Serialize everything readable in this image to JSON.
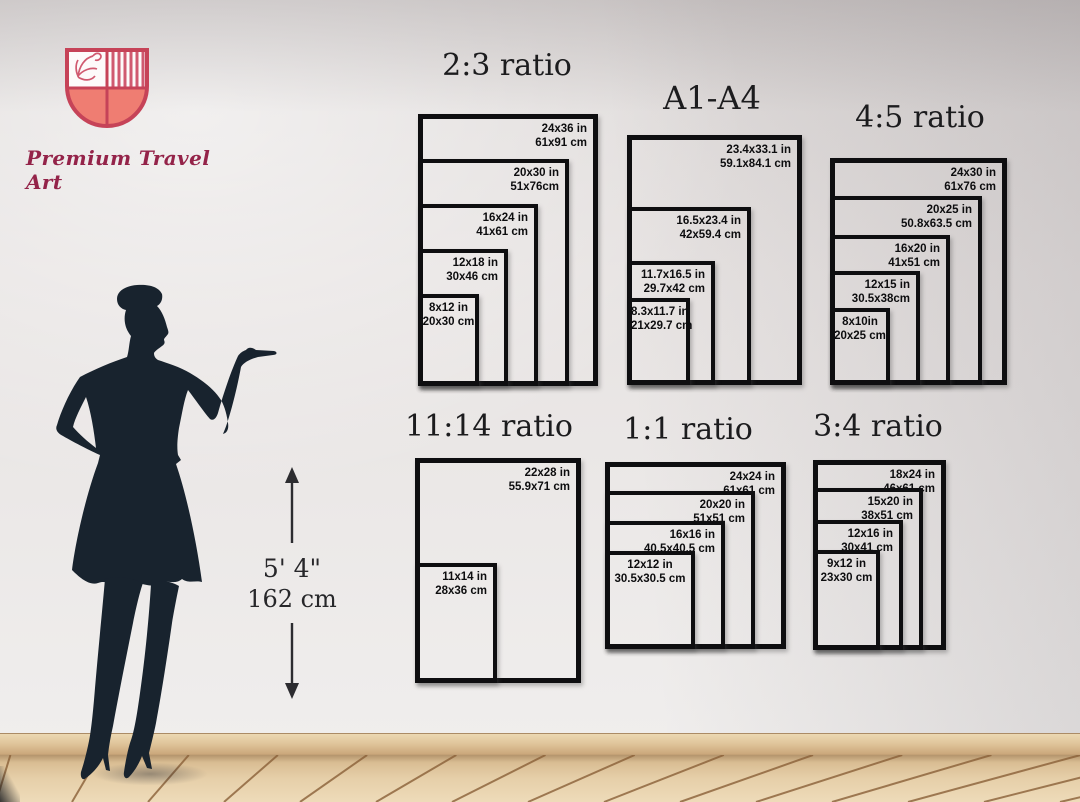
{
  "brand": {
    "name": "Premium Travel Art"
  },
  "height_indicator": {
    "feet": "5' 4\"",
    "cm": "162 cm"
  },
  "groups": [
    {
      "title": "2:3 ratio",
      "sizes": [
        {
          "inches": "24x36 in",
          "cm": "61x91 cm"
        },
        {
          "inches": "20x30 in",
          "cm": "51x76cm"
        },
        {
          "inches": "16x24 in",
          "cm": "41x61 cm"
        },
        {
          "inches": "12x18 in",
          "cm": "30x46 cm"
        },
        {
          "inches": "8x12 in",
          "cm": "20x30 cm"
        }
      ]
    },
    {
      "title": "A1-A4",
      "sizes": [
        {
          "inches": "23.4x33.1 in",
          "cm": "59.1x84.1 cm"
        },
        {
          "inches": "16.5x23.4 in",
          "cm": "42x59.4 cm"
        },
        {
          "inches": "11.7x16.5 in",
          "cm": "29.7x42 cm"
        },
        {
          "inches": "8.3x11.7 in",
          "cm": "21x29.7 cm"
        }
      ]
    },
    {
      "title": "4:5 ratio",
      "sizes": [
        {
          "inches": "24x30 in",
          "cm": "61x76 cm"
        },
        {
          "inches": "20x25 in",
          "cm": "50.8x63.5 cm"
        },
        {
          "inches": "16x20 in",
          "cm": "41x51 cm"
        },
        {
          "inches": "12x15 in",
          "cm": "30.5x38cm"
        },
        {
          "inches": "8x10in",
          "cm": "20x25 cm"
        }
      ]
    },
    {
      "title": "11:14 ratio",
      "sizes": [
        {
          "inches": "22x28 in",
          "cm": "55.9x71 cm"
        },
        {
          "inches": "11x14 in",
          "cm": "28x36 cm"
        }
      ]
    },
    {
      "title": "1:1 ratio",
      "sizes": [
        {
          "inches": "24x24 in",
          "cm": "61x61 cm"
        },
        {
          "inches": "20x20 in",
          "cm": "51x51 cm"
        },
        {
          "inches": "16x16 in",
          "cm": "40.5x40.5 cm"
        },
        {
          "inches": "12x12 in",
          "cm": "30.5x30.5 cm"
        }
      ]
    },
    {
      "title": "3:4 ratio",
      "sizes": [
        {
          "inches": "18x24 in",
          "cm": "46x61 cm"
        },
        {
          "inches": "15x20 in",
          "cm": "38x51 cm"
        },
        {
          "inches": "12x16 in",
          "cm": "30x41 cm"
        },
        {
          "inches": "9x12 in",
          "cm": "23x30 cm"
        }
      ]
    }
  ],
  "colors": {
    "brand_text": "#942349",
    "shield_outline": "#c64358",
    "shield_fill": "#ef7d72",
    "silhouette": "#18232e",
    "box_border": "#0e0e10",
    "wall": "#e7e3e2",
    "floor": "#e0c8a4",
    "baseboard": "#dfc49a"
  }
}
